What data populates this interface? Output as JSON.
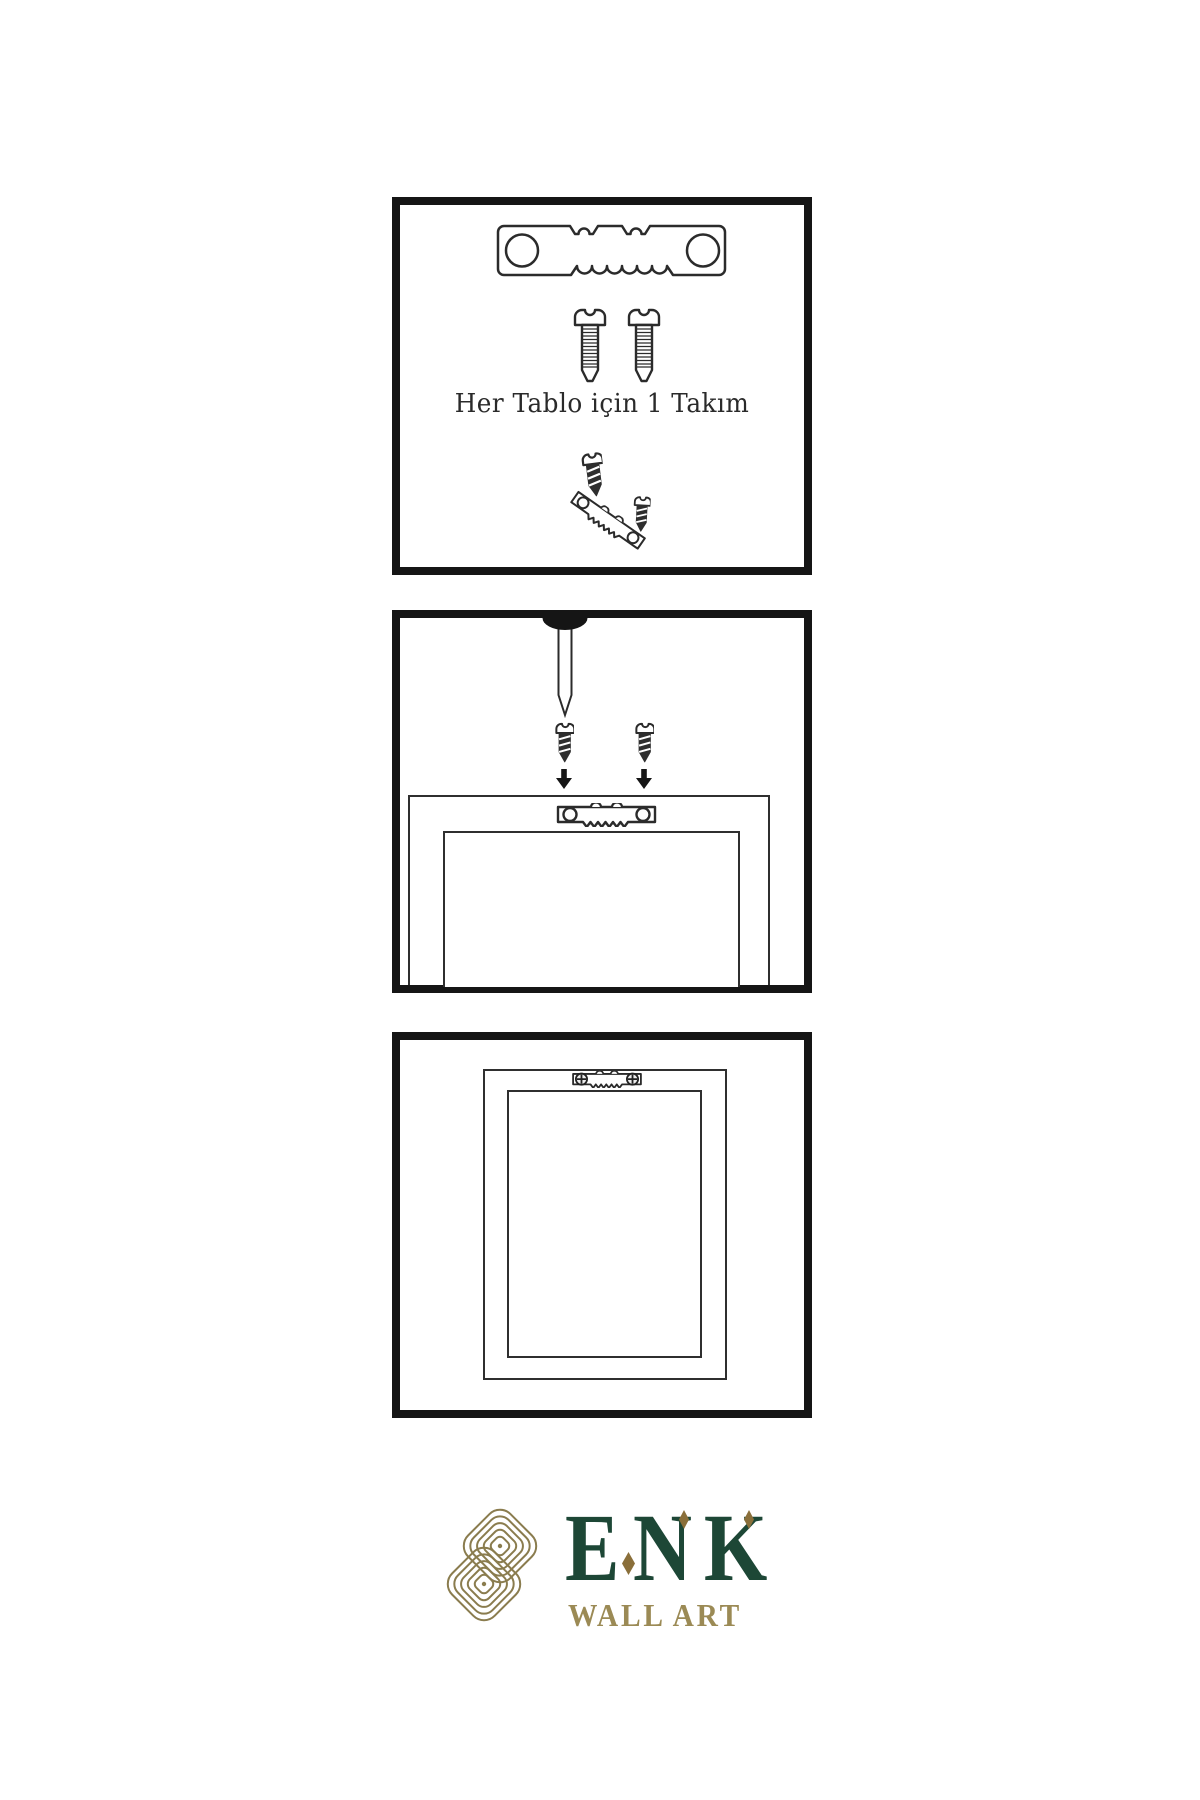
{
  "page": {
    "width": 1200,
    "height": 1800,
    "background": "#ffffff"
  },
  "colors": {
    "panel_border": "#151515",
    "line_art": "#2b2b2b",
    "dark_metal": "#2e2e2e",
    "logo_green": "#1d4736",
    "logo_gold": "#9b8a55",
    "knot_gold": "#8a7c4e",
    "diamond_gold": "#8a6f3a"
  },
  "panels": [
    {
      "name": "hardware-kit",
      "caption": "Her Tablo için 1 Takım",
      "contents": [
        "sawtooth-hanger",
        "mounting-screw",
        "mounting-screw",
        "small-dark-screw",
        "angled-sawtooth-hanger",
        "small-dark-screw"
      ]
    },
    {
      "name": "installation-step",
      "contents": [
        "wall-nail",
        "dark-screw",
        "dark-screw",
        "down-arrow",
        "down-arrow",
        "frame-back",
        "sawtooth-hanger"
      ]
    },
    {
      "name": "mounted-frame",
      "contents": [
        "frame-back",
        "installed-sawtooth-hanger-with-phillips-screws"
      ]
    }
  ],
  "logo": {
    "letters": [
      "E",
      "N",
      "K"
    ],
    "subtitle": "WALL ART"
  }
}
